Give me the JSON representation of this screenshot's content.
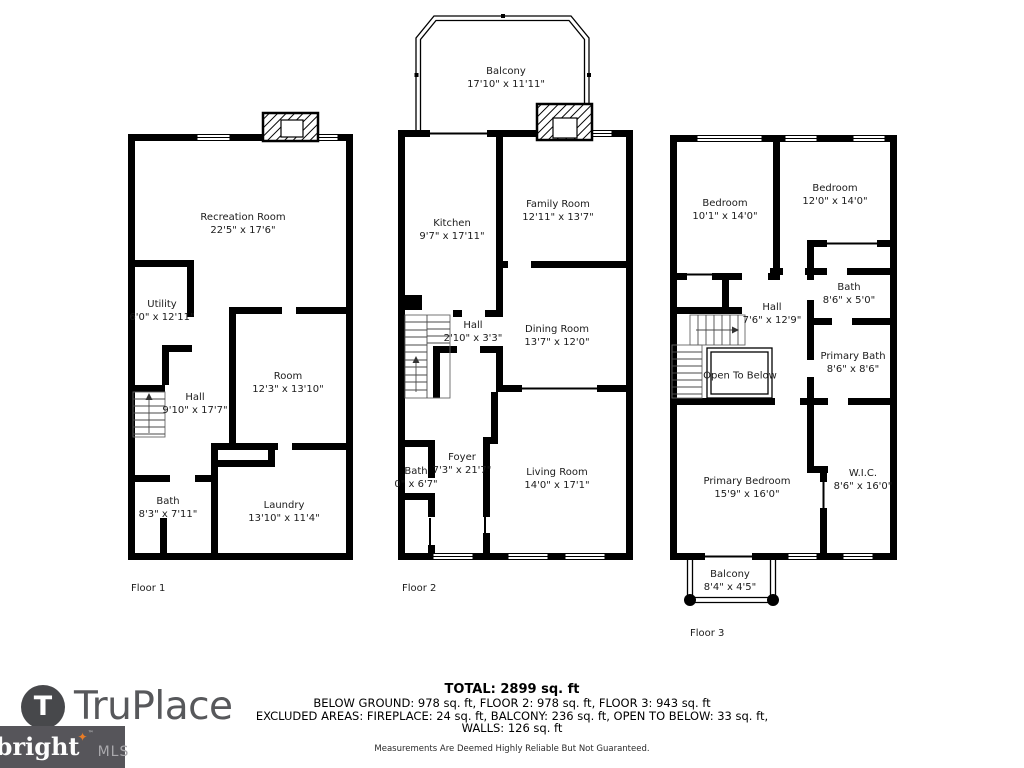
{
  "floors": [
    {
      "label": "Floor 1",
      "rooms": [
        {
          "name": "Recreation Room",
          "dims": "22'5\" x 17'6\""
        },
        {
          "name": "Utility",
          "dims": "6'0\" x 12'11\""
        },
        {
          "name": "Hall",
          "dims": "9'10\" x 17'7\""
        },
        {
          "name": "Room",
          "dims": "12'3\" x 13'10\""
        },
        {
          "name": "Bath",
          "dims": "8'3\" x 7'11\""
        },
        {
          "name": "Laundry",
          "dims": "13'10\" x 11'4\""
        }
      ]
    },
    {
      "label": "Floor 2",
      "rooms": [
        {
          "name": "Balcony",
          "dims": "17'10\" x 11'11\""
        },
        {
          "name": "Kitchen",
          "dims": "9'7\" x 17'11\""
        },
        {
          "name": "Family Room",
          "dims": "12'11\" x 13'7\""
        },
        {
          "name": "Hall",
          "dims": "2'10\" x 3'3\""
        },
        {
          "name": "Dining Room",
          "dims": "13'7\" x 12'0\""
        },
        {
          "name": "Foyer",
          "dims": "7'3\" x 21'7\""
        },
        {
          "name": "Bath",
          "dims": "0\" x 6'7\""
        },
        {
          "name": "Living Room",
          "dims": "14'0\" x 17'1\""
        }
      ]
    },
    {
      "label": "Floor 3",
      "rooms": [
        {
          "name": "Bedroom",
          "dims": "10'1\" x 14'0\""
        },
        {
          "name": "Bedroom",
          "dims": "12'0\" x 14'0\""
        },
        {
          "name": "Bath",
          "dims": "8'6\" x 5'0\""
        },
        {
          "name": "Hall",
          "dims": "7'6\" x 12'9\""
        },
        {
          "name": "Primary Bath",
          "dims": "8'6\" x 8'6\""
        },
        {
          "name": "Open To Below",
          "dims": ""
        },
        {
          "name": "Primary Bedroom",
          "dims": "15'9\" x 16'0\""
        },
        {
          "name": "W.I.C.",
          "dims": "8'6\" x 16'0\""
        },
        {
          "name": "Balcony",
          "dims": "8'4\" x 4'5\""
        }
      ]
    }
  ],
  "footer": {
    "total": "TOTAL: 2899 sq. ft",
    "line2": "BELOW GROUND: 978 sq. ft, FLOOR 2: 978 sq. ft, FLOOR 3: 943 sq. ft",
    "line3": "EXCLUDED AREAS: FIREPLACE: 24 sq. ft, BALCONY: 236 sq. ft, OPEN TO BELOW: 33 sq. ft,",
    "line4": "WALLS: 126 sq. ft",
    "disclaimer": "Measurements Are Deemed Highly Reliable But Not Guaranteed."
  },
  "branding": {
    "truplace": {
      "icon_letter": "T",
      "wordmark": "TruPlace"
    },
    "bright_mls": {
      "wordmark": "bright",
      "star": "✦",
      "tm": "™",
      "suffix": "MLS"
    },
    "colors": {
      "wall": "#000000",
      "logo_gray": "#57585b",
      "bright_bg": "#56555a",
      "bright_orange": "#e97c26"
    }
  }
}
